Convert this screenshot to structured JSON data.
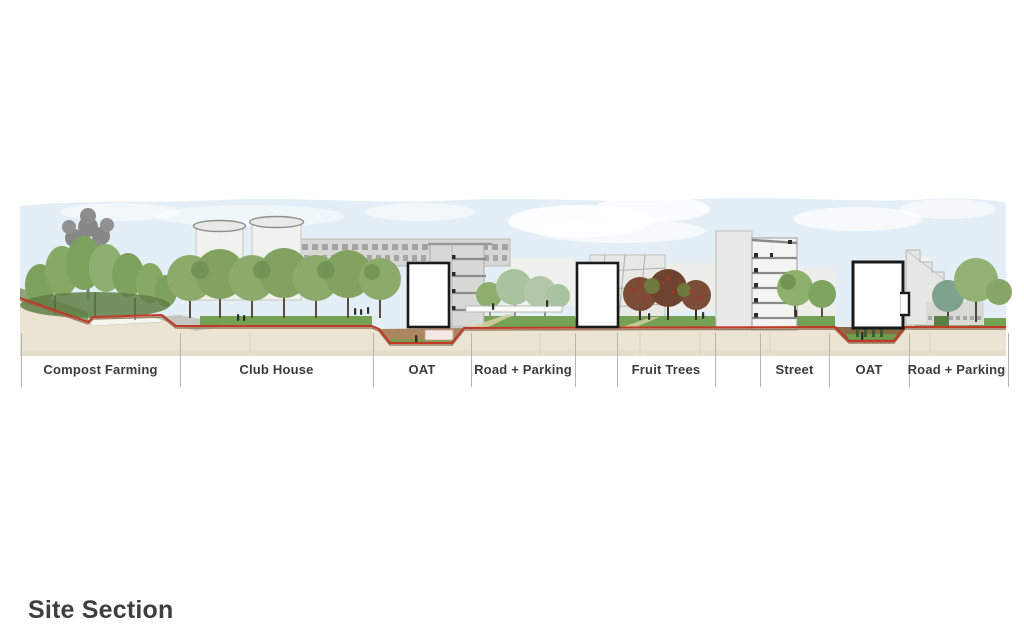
{
  "title": "Site Section",
  "section": {
    "zones": [
      {
        "label": "Compost Farming"
      },
      {
        "label": "Club House"
      },
      {
        "label": "OAT"
      },
      {
        "label": "Road + Parking"
      },
      {
        "label": "Fruit Trees"
      },
      {
        "label": "Street"
      },
      {
        "label": "OAT"
      },
      {
        "label": "Road + Parking"
      }
    ],
    "colors": {
      "sky": "#e3eef6",
      "ground": "#ebe4d3",
      "terrain_line": "#c13a28",
      "grass": "#74a153",
      "foliage": "#86a766",
      "fruit_foliage": "#7b4c36",
      "section_marker_outline": "#1a1a1a",
      "label_text": "#3c3c3c"
    }
  }
}
